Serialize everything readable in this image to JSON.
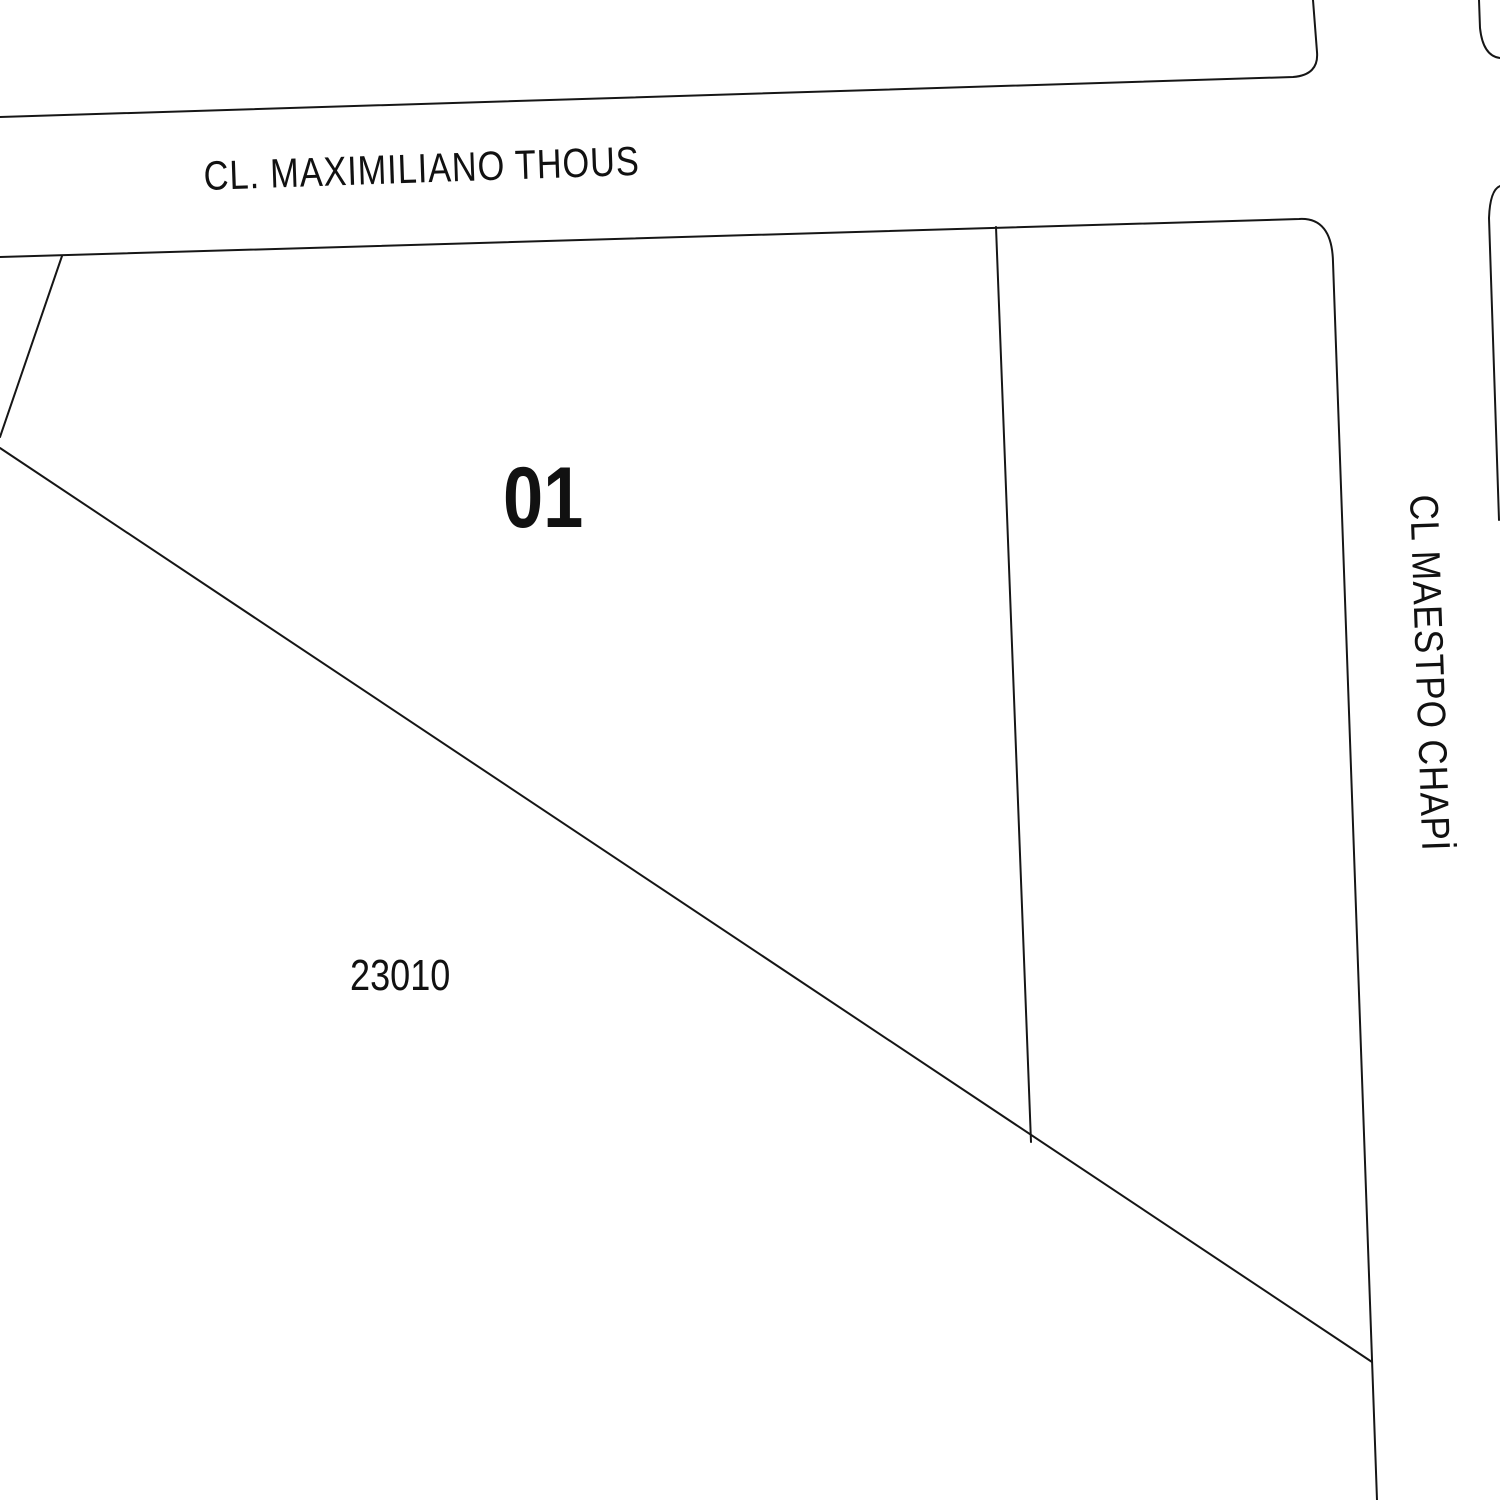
{
  "map": {
    "type": "cadastral-parcel-map",
    "background_color": "#ffffff",
    "line_color": "#161616",
    "label_color": "#111111",
    "streets": {
      "top": {
        "name": "CL. MAXIMILIANO THOUS",
        "orientation": "horizontal"
      },
      "right": {
        "name": "CL MAESTPO CHAPİ",
        "orientation": "vertical"
      }
    },
    "parcels": [
      {
        "number": "01"
      }
    ],
    "blocks": [
      {
        "number": "23010"
      }
    ]
  }
}
